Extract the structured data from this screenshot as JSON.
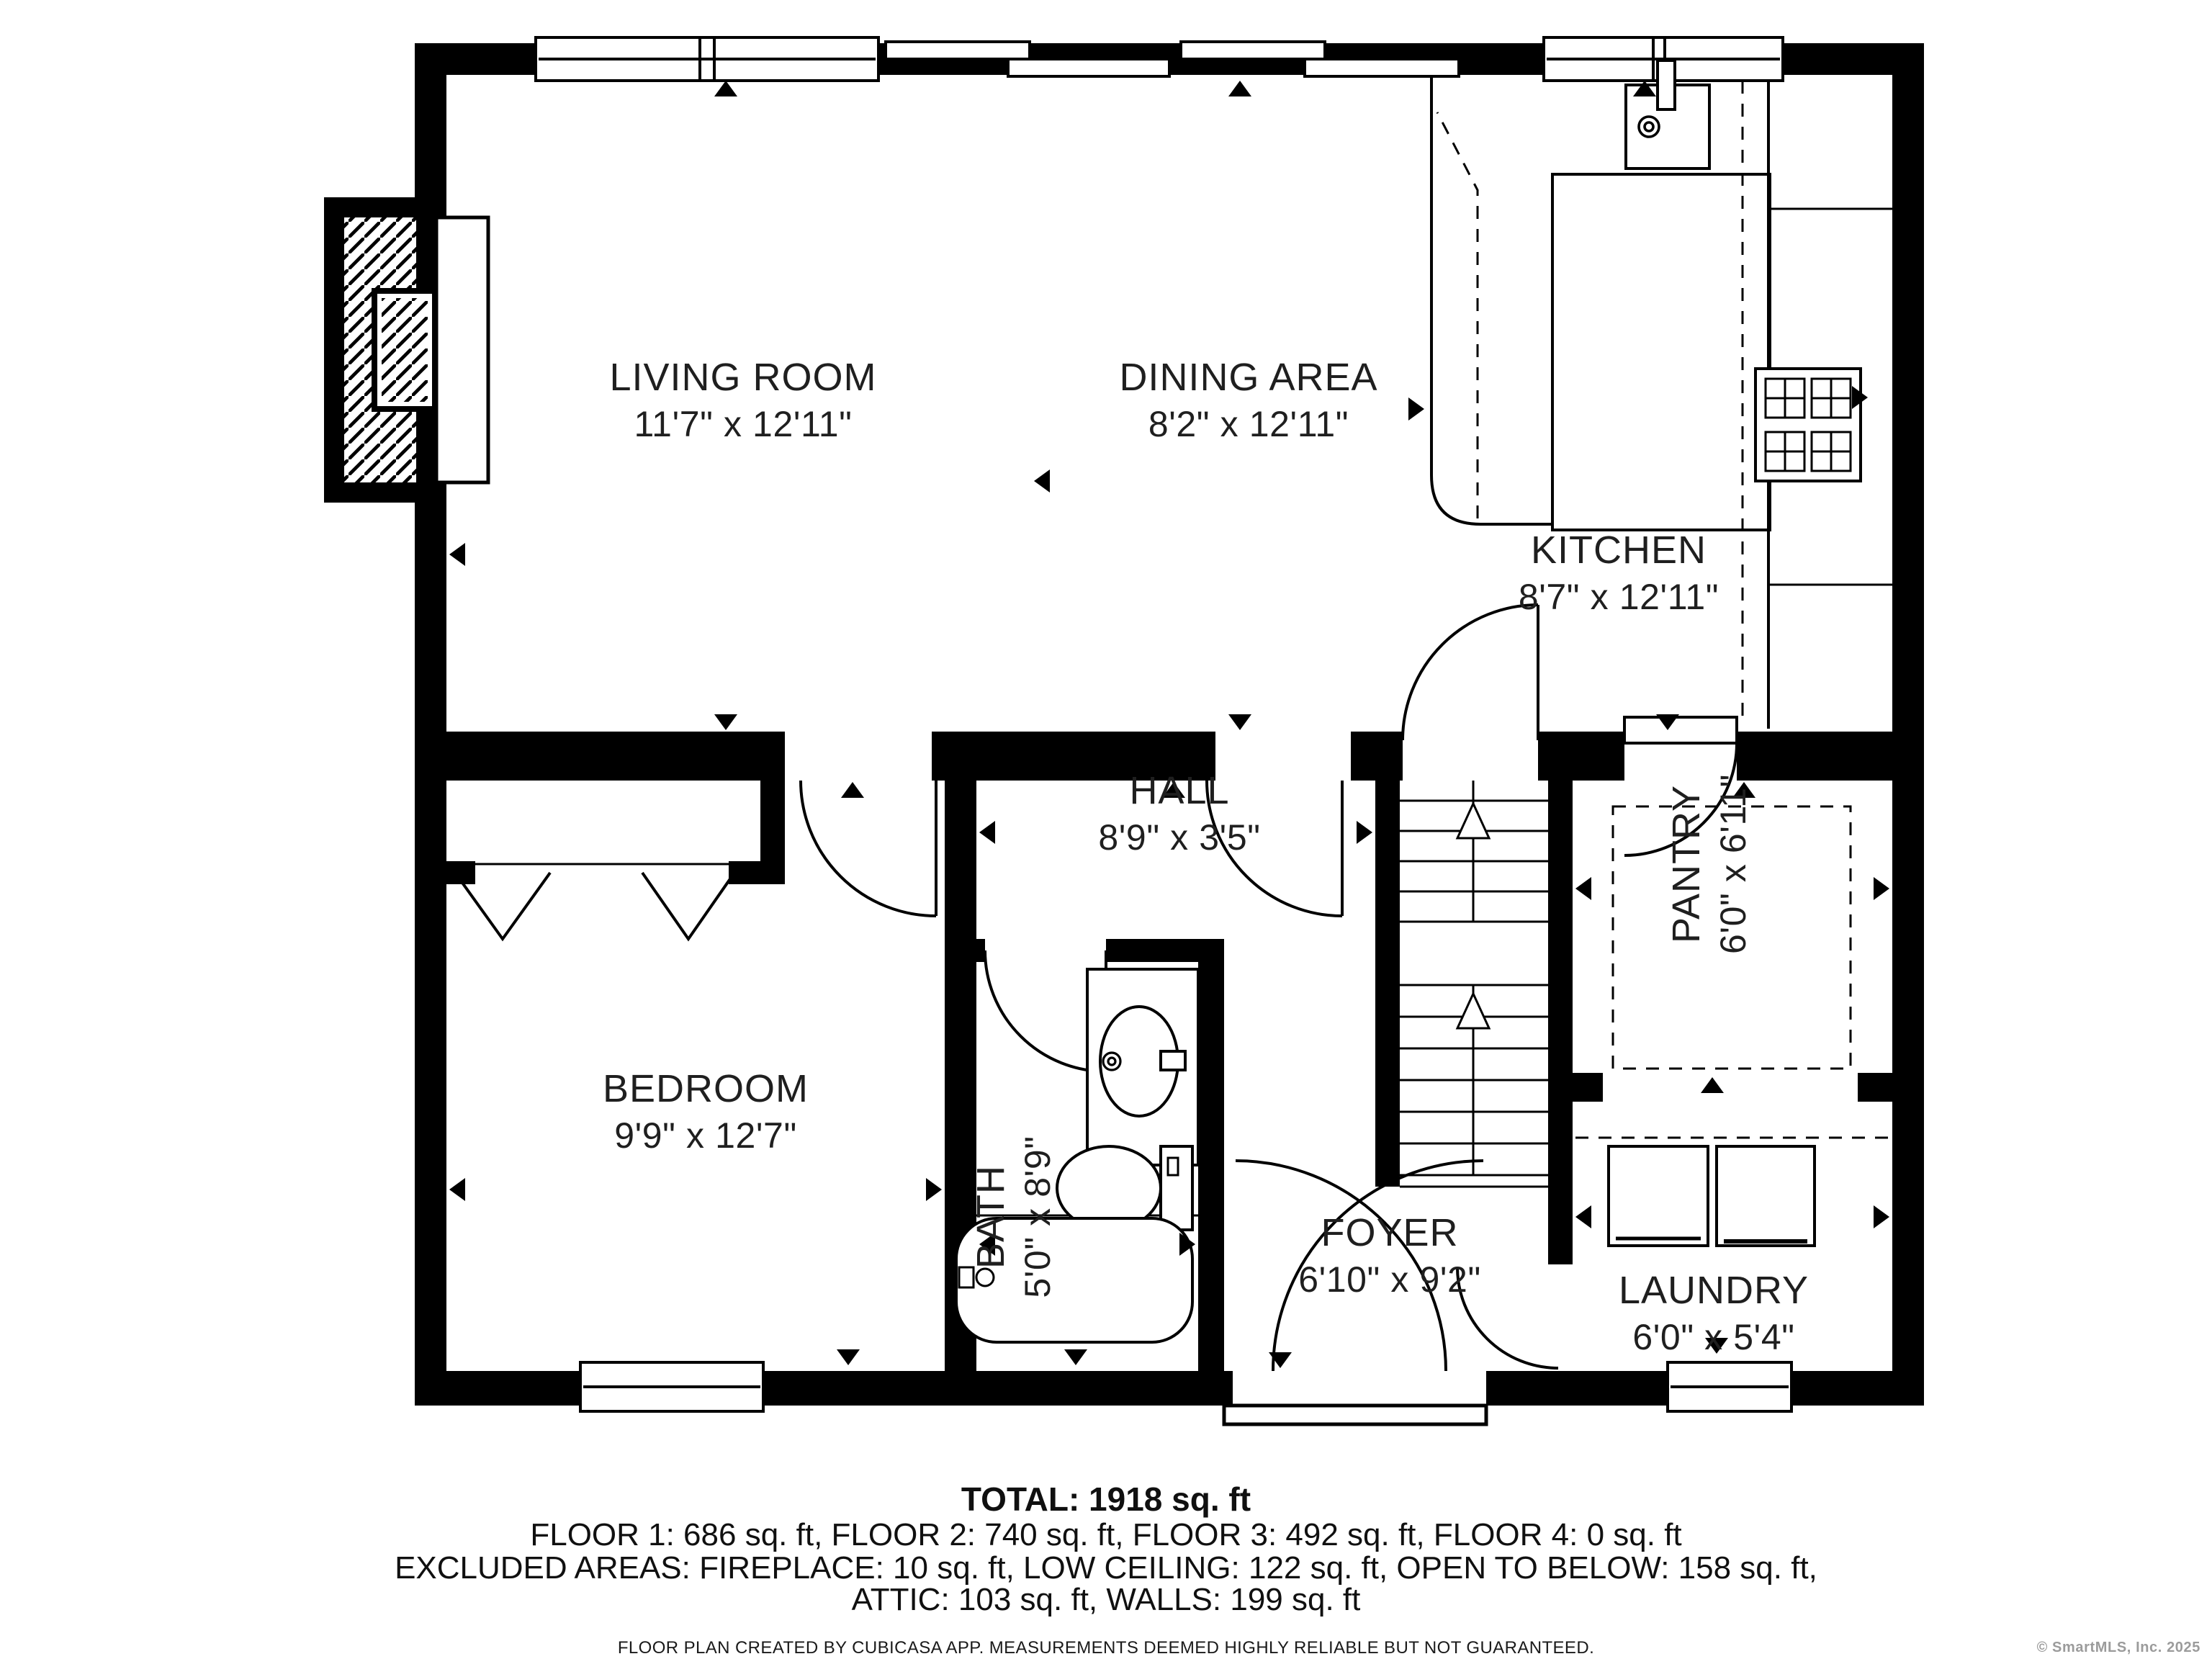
{
  "plan": {
    "rooms": [
      {
        "id": "living_room",
        "name": "LIVING ROOM",
        "dims": "11'7\" x 12'11\""
      },
      {
        "id": "dining_area",
        "name": "DINING AREA",
        "dims": "8'2\" x 12'11\""
      },
      {
        "id": "kitchen",
        "name": "KITCHEN",
        "dims": "8'7\" x 12'11\""
      },
      {
        "id": "hall",
        "name": "HALL",
        "dims": "8'9\" x 3'5\""
      },
      {
        "id": "pantry",
        "name": "PANTRY",
        "dims": "6'0\" x 6'11\""
      },
      {
        "id": "bedroom",
        "name": "BEDROOM",
        "dims": "9'9\" x 12'7\""
      },
      {
        "id": "bath",
        "name": "BATH",
        "dims": "5'0\" x 8'9\""
      },
      {
        "id": "foyer",
        "name": "FOYER",
        "dims": "6'10\" x 9'2\""
      },
      {
        "id": "laundry",
        "name": "LAUNDRY",
        "dims": "6'0\" x 5'4\""
      }
    ],
    "fixtures": [
      "fireplace",
      "kitchen-sink",
      "kitchen-island",
      "kitchen-counter",
      "stove",
      "staircase",
      "bathroom-sink",
      "toilet",
      "bathtub",
      "washer",
      "dryer",
      "closet-bifold-doors",
      "front-door",
      "windows",
      "door-swings"
    ]
  },
  "summary": {
    "total": "TOTAL: 1918 sq. ft",
    "floors": "FLOOR 1: 686 sq. ft, FLOOR 2: 740 sq. ft, FLOOR 3: 492 sq. ft, FLOOR 4: 0 sq. ft",
    "excluded_line1": "EXCLUDED AREAS: FIREPLACE: 10 sq. ft, LOW CEILING: 122 sq. ft, OPEN TO BELOW: 158 sq. ft,",
    "excluded_line2": "ATTIC: 103 sq. ft, WALLS: 199 sq. ft",
    "disclaimer": "FLOOR PLAN CREATED BY CUBICASA APP. MEASUREMENTS DEEMED HIGHLY RELIABLE BUT NOT GUARANTEED."
  },
  "copyright": "© SmartMLS, Inc.  2025",
  "colors": {
    "wall": "#000000",
    "text": "#1f1f1f",
    "muted": "#9b9b9b",
    "background": "#ffffff"
  }
}
